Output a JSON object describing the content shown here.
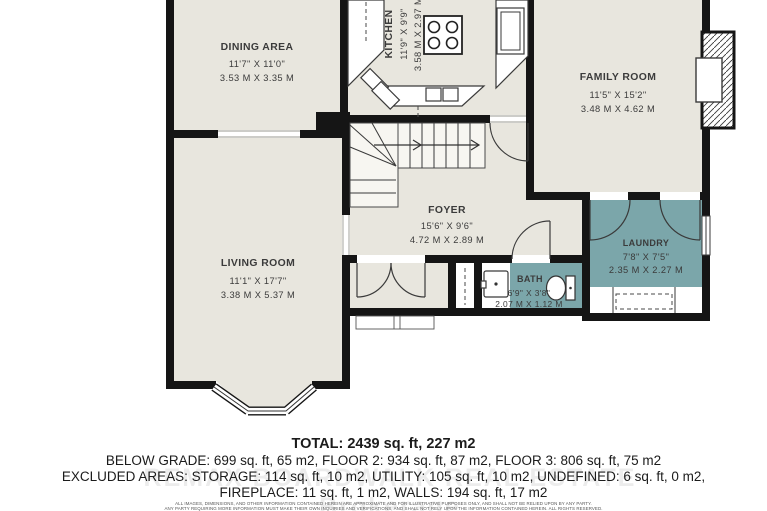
{
  "plan": {
    "rooms": [
      {
        "id": "dining",
        "name": "DINING AREA",
        "imperial": "11'7\" X 11'0\"",
        "metric": "3.53 M X 3.35 M"
      },
      {
        "id": "kitchen",
        "name": "KITCHEN",
        "imperial": "11'9\" X 9'9\"",
        "metric": "3.58 M X 2.97 M"
      },
      {
        "id": "family",
        "name": "FAMILY ROOM",
        "imperial": "11'5\" X 15'2\"",
        "metric": "3.48 M X 4.62 M"
      },
      {
        "id": "living",
        "name": "LIVING ROOM",
        "imperial": "11'1\" X 17'7\"",
        "metric": "3.38 M X 5.37 M"
      },
      {
        "id": "foyer",
        "name": "FOYER",
        "imperial": "15'6\" X 9'6\"",
        "metric": "4.72 M X 2.89 M"
      },
      {
        "id": "bath",
        "name": "BATH",
        "imperial": "6'9\" X 3'8\"",
        "metric": "2.07 M X 1.12 M"
      },
      {
        "id": "laundry",
        "name": "LAUNDRY",
        "imperial": "7'8\" X 7'5\"",
        "metric": "2.35 M X 2.27 M"
      }
    ],
    "colors": {
      "room_fill": "#e8e6de",
      "accent_room_fill": "#7ba6aa",
      "wall": "#151515",
      "label_text": "#3b3b3b"
    }
  },
  "summary": {
    "total": "TOTAL: 2439 sq. ft, 227 m2",
    "line2": "BELOW GRADE: 699 sq. ft, 65 m2, FLOOR 2: 934 sq. ft, 87 m2, FLOOR 3: 806 sq. ft, 75 m2",
    "line3": "EXCLUDED AREAS: STORAGE: 114 sq. ft, 10 m2, UTILITY: 105 sq. ft, 10 m2, UNDEFINED: 6 sq. ft, 0 m2,",
    "line4": "FIREPLACE: 11 sq. ft, 1 m2, WALLS: 194 sq. ft, 17 m2",
    "disclaimer1": "ALL IMAGES, DIMENSIONS, AND OTHER INFORMATION CONTAINED HEREIN ARE APPROXIMATE AND FOR ILLUSTRATIVE PURPOSES ONLY, AND SHALL NOT BE RELIED UPON BY ANY PARTY.",
    "disclaimer2": "ANY PARTY REQUIRING MORE INFORMATION MUST MAKE THEIR OWN INQUIRIES AND VERIFICATIONS, AND SHALL NOT RELY UPON THE INFORMATION CONTAINED HEREIN. ALL RIGHTS RESERVED.",
    "watermark": "REMAX BOARDWALK REAL ESTATE Brokerage"
  }
}
